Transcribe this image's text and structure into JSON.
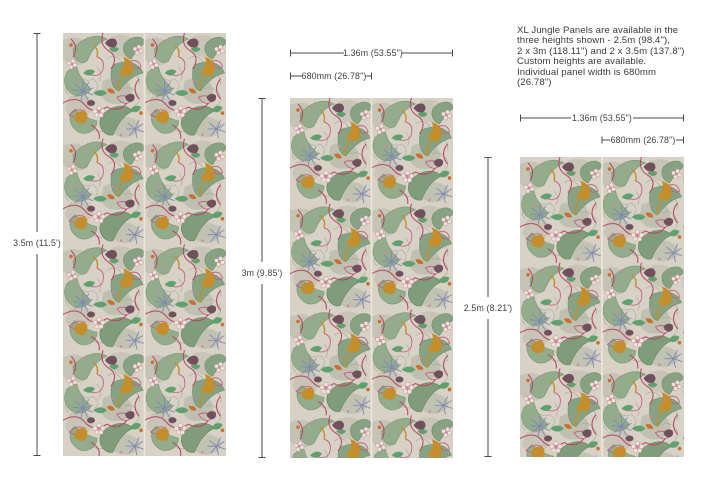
{
  "info_text": "XL Jungle Panels are available in the\nthree heights shown - 2.5m (98.4\"),\n2 x 3m (118.11\") and 2 x 3.5m (137.8\")\nCustom heights are available.\nIndividual panel width is 680mm\n(26.78\")",
  "panels": [
    {
      "name": "panel-3.5m",
      "height_label": "3.5m (11.5')"
    },
    {
      "name": "panel-3m",
      "height_label": "3m (9.85')",
      "overall_width_label": "1.36m (53.55\")",
      "single_width_label": "680mm (26.78\")"
    },
    {
      "name": "panel-2.5m",
      "height_label": "2.5m (8.21')",
      "overall_width_label": "1.36m (53.55\")",
      "single_width_label": "680mm (26.78\")"
    }
  ],
  "colors": {
    "page_background": "#ffffff",
    "text": "#3b3b3b",
    "dimension_line": "#484848",
    "pattern_background": "#d7d2c5",
    "pattern_sage_green": "#93ac8c",
    "pattern_dark_green": "#6e8e6c",
    "pattern_bright_green": "#61a06e",
    "pattern_magenta": "#c55181",
    "pattern_crimson": "#b84063",
    "pattern_blue_lilac": "#8087b6",
    "pattern_mustard": "#c38e2b",
    "pattern_orange": "#c8702f",
    "pattern_plum": "#6f505c",
    "pattern_cream": "#ece6d8",
    "pattern_pink": "#d183a2",
    "seam": "#ece6d8"
  }
}
